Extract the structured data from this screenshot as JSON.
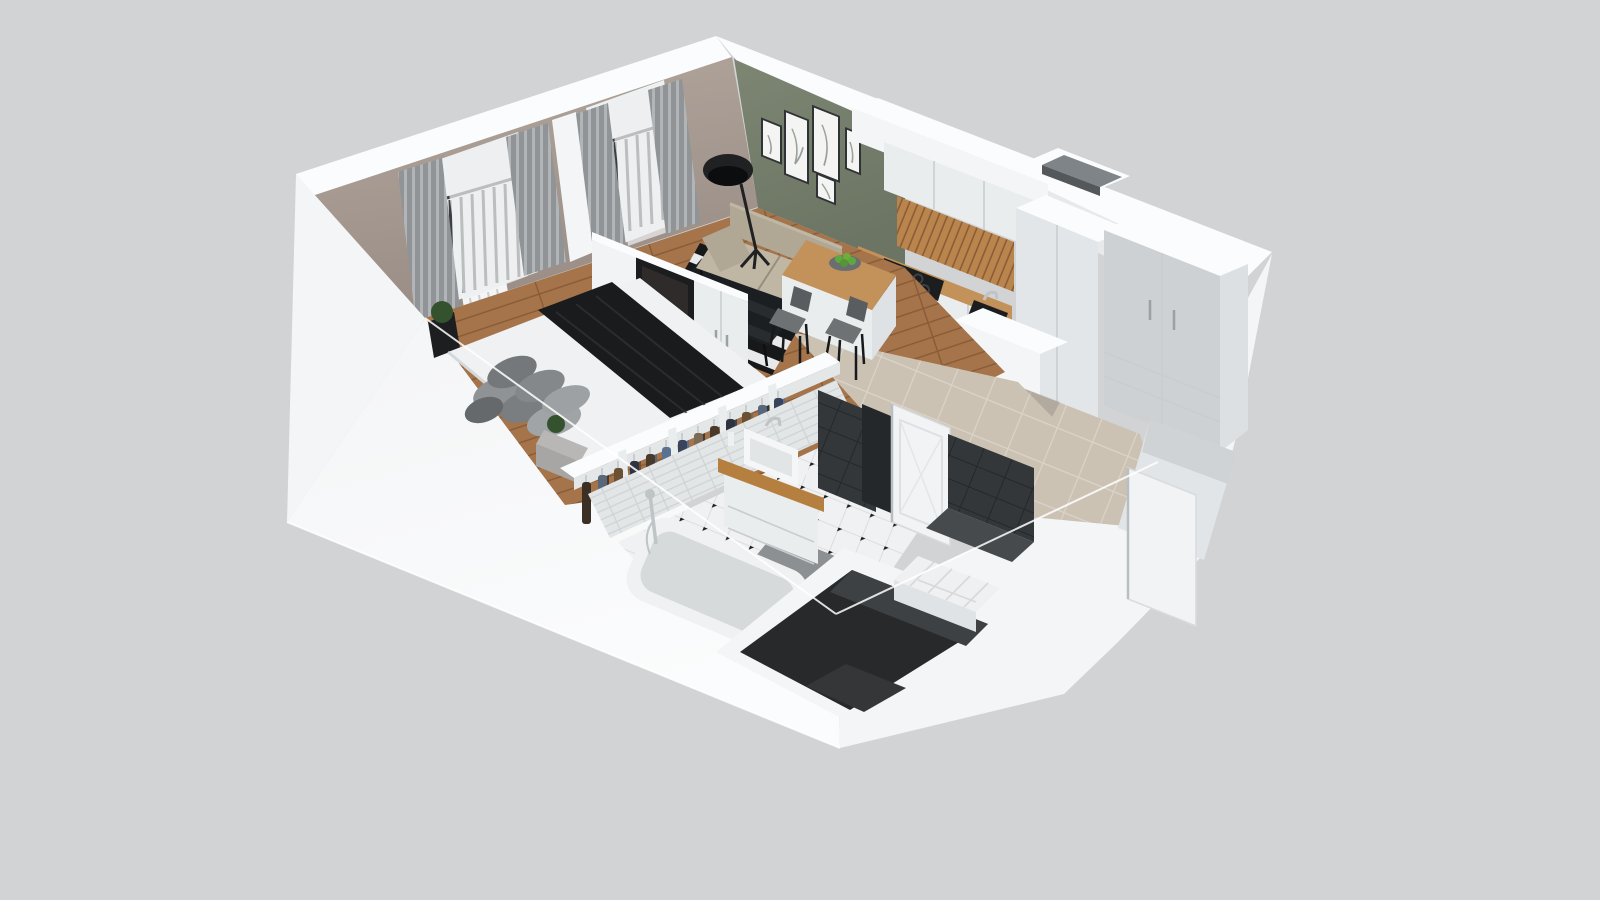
{
  "scene": {
    "type": "isometric-3d-floorplan-render",
    "description": "3D cutaway floor plan of a studio apartment viewed from above: bedroom with double bed and balcony windows, living area with sofa and striped rug, kitchen with peninsula, open wardrobe, bathroom with tub and vanity, entry hall and utility shaft, all inside thick white walls on a plain gray background",
    "rooms": [
      {
        "name": "bedroom",
        "floor": "oak plank",
        "items": [
          "double bed with white duvet",
          "dark throw blanket",
          "gray pillow pile",
          "concrete nightstand with plant",
          "black planter with plant",
          "white sphere floor lamp",
          "white radiator",
          "gray curtains",
          "white sheer curtains",
          "balcony windows with dark railing",
          "tv partition wall with flat tv"
        ]
      },
      {
        "name": "living-area",
        "floor": "oak plank",
        "items": [
          "sage green accent wall",
          "five framed line-art prints",
          "black floor lamp",
          "beige two-seat sofa",
          "black and white striped rug",
          "dark glass coffee table",
          "white storage cabinet"
        ]
      },
      {
        "name": "kitchen",
        "floor": "beige tile",
        "items": [
          "white upper cabinets",
          "oak slat backsplash",
          "black cooktop",
          "built-in oven",
          "dark sink with faucet",
          "oak countertop",
          "oak peninsula with fruit bowl of green apples",
          "two gray dining chairs",
          "tall white housing unit",
          "open utility shaft"
        ]
      },
      {
        "name": "hallway-entry",
        "floor": "beige tile",
        "items": [
          "tall light-gray wardrobe",
          "entrance niche",
          "open white front door"
        ]
      },
      {
        "name": "wardrobe-closet",
        "items": [
          "open double clothes rack",
          "hanging garments in brown, navy, denim and gray",
          "white dividers"
        ]
      },
      {
        "name": "bathroom",
        "floor": "white octagon tile with black dots",
        "items": [
          "bathtub with chrome shower",
          "white vanity with oak top and vessel sink",
          "anthracite tile panels",
          "gray bath mat",
          "open white paneled door",
          "dark toilet niche",
          "white tiled step"
        ]
      },
      {
        "name": "utility-shaft",
        "items": [
          "dark open vertical shaft"
        ]
      },
      {
        "name": "balcony",
        "items": [
          "dark metal railing"
        ]
      }
    ]
  },
  "palette": {
    "bg": "#d2d3d5",
    "wall": "#f4f5f6",
    "wall_bright": "#fbfcfd",
    "wall_shade": "#e7e9eb",
    "taupe": "#b2a69d",
    "taupe_dark": "#998d85",
    "green": "#7d8573",
    "green_dark": "#6c7463",
    "glass_light": "#eef1f2",
    "railing": "#3c4043",
    "curtain_a": "#909497",
    "curtain_b": "#b2b5b7",
    "sheer": "#edeff0",
    "wood": "#a5744a",
    "wood_line": "#8a5c38",
    "rug_black": "#17181a",
    "rug_white": "#e8e9ea",
    "glass_dark": "#1d2022",
    "sofa": "#b0a795",
    "sofa_light": "#bfb6a4",
    "sofa_dark": "#978e7c",
    "counter_wood": "#c3925a",
    "cab_white": "#eaedee",
    "cab_seam": "#c9cdd0",
    "wardrobe_gray": "#cdd1d3",
    "slat_wood": "#b9854d",
    "appliance_dark": "#1b1d1f",
    "appliance_mid": "#303336",
    "steel": "#bfc4c7",
    "beige_tile": "#cbc2b4",
    "beige_grout": "#dbd4c8",
    "door_white": "#f1f3f4",
    "bed_white": "#eff1f2",
    "blanket": "#191b1c",
    "pillow_a": "#8f9395",
    "pillow_b": "#74787a",
    "pillow_c": "#a0a4a6",
    "nightstand": "#a8a5a5",
    "plant": "#35522f",
    "apple": "#5fa83e",
    "bath_tile": "#e3e6e7",
    "bath_tile_line": "#cfd3d5",
    "dark_tile": "#33373a",
    "dark_tile2": "#24282a",
    "bath_floor": "#eff1f2",
    "bath_grid": "#d6d9da",
    "mat": "#8d9092",
    "tub_rim": "#eff1f2",
    "tub_basin": "#d7dadb",
    "shaft_wall": "#27292b",
    "shaft_wall2": "#3e4143",
    "shaft_floor": "#343638",
    "lamp_black": "#1f2123"
  }
}
